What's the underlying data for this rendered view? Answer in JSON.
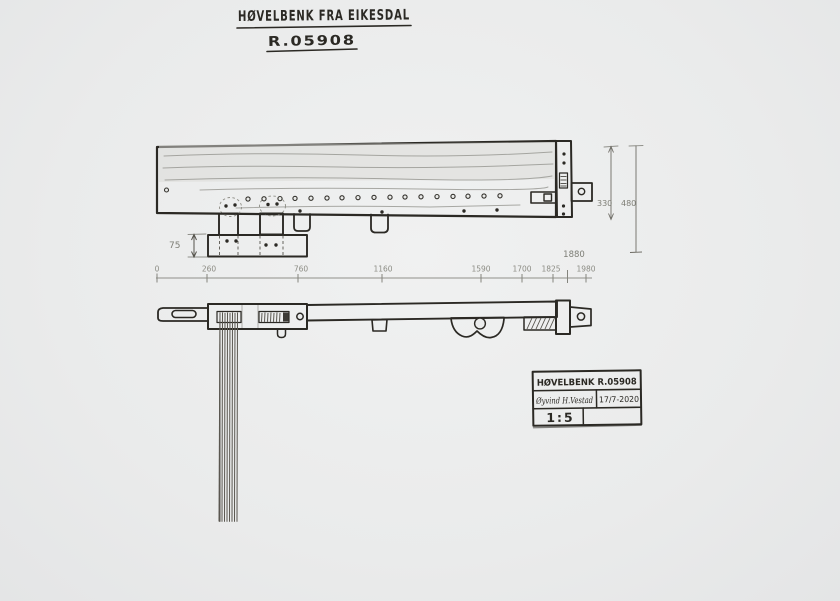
{
  "sheet": {
    "title": "HØVELBENK FRA EIKESDAL",
    "catalog_number": "R.05908"
  },
  "dimensions": {
    "rail_height": "75",
    "bench_width": "330",
    "total_width": "480",
    "length_to_shoulder": "1880",
    "ticks": [
      "0",
      "260",
      "760",
      "1160",
      "1590",
      "1700",
      "1825",
      "1980"
    ]
  },
  "title_block": {
    "name": "HØVELBENK R.05908",
    "signature": "Øyvind H.Vestad",
    "date": "17/7-2020",
    "scale": "1:5"
  },
  "colors": {
    "paper": "#ebecec",
    "ink": "#2b2924",
    "pencil": "#8f8f87",
    "shading": "#d9dad6"
  }
}
